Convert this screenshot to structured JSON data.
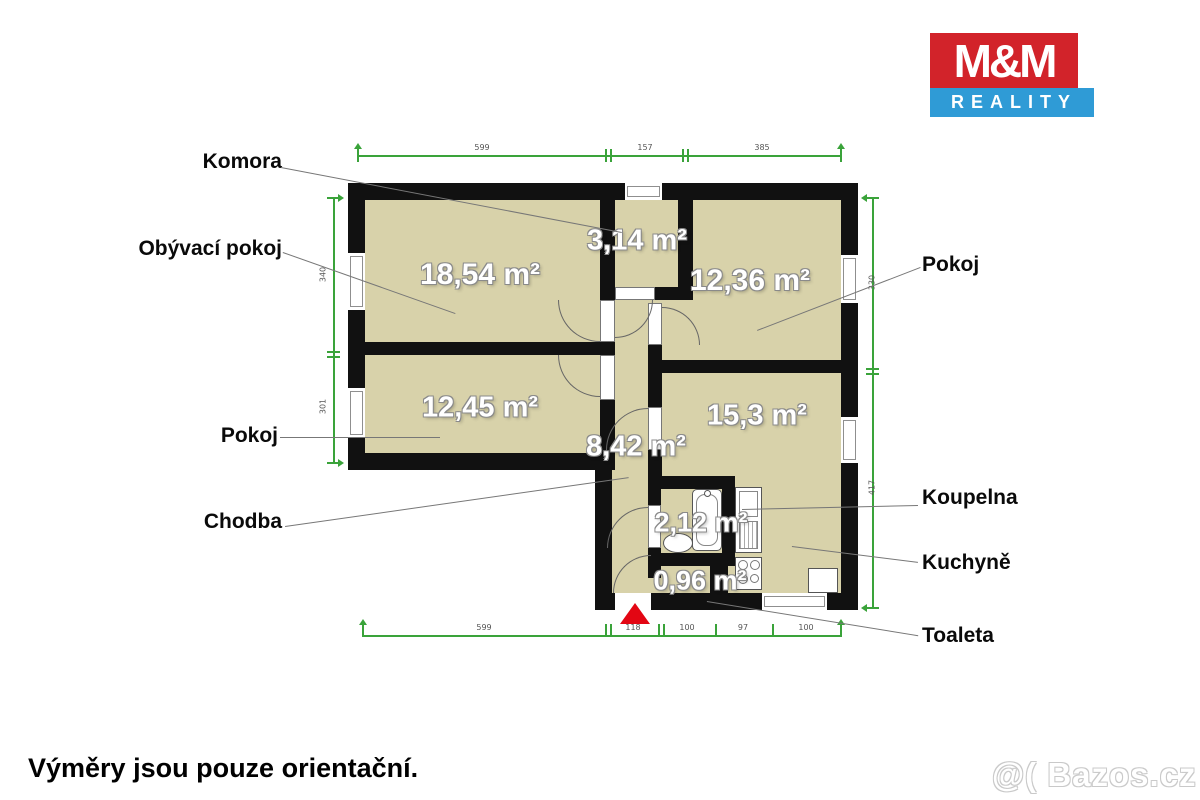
{
  "logo": {
    "top": "M&M",
    "bottom": "REALITY"
  },
  "plan": {
    "room_labels": [
      {
        "text": "Komora"
      },
      {
        "text": "Obývací pokoj"
      },
      {
        "text": "Pokoj"
      },
      {
        "text": "Chodba"
      },
      {
        "text": "Pokoj"
      },
      {
        "text": "Koupelna"
      },
      {
        "text": "Kuchyně"
      },
      {
        "text": "Toaleta"
      }
    ],
    "areas": [
      {
        "room": "Obývací pokoj",
        "text": "18,54 m²"
      },
      {
        "room": "Komora",
        "text": "3,14 m²"
      },
      {
        "room": "Pokoj pravý",
        "text": "12,36 m²"
      },
      {
        "room": "Pokoj levý",
        "text": "12,45 m²"
      },
      {
        "room": "Kuchyně",
        "text": "15,3 m²"
      },
      {
        "room": "Chodba",
        "text": "8,42 m²"
      },
      {
        "room": "Koupelna",
        "text": "2,12 m²"
      },
      {
        "room": "Toaleta",
        "text": "0,96 m²"
      }
    ],
    "dimensions": {
      "top": [
        "599",
        "157",
        "385"
      ],
      "left": [
        "340",
        "301"
      ],
      "right": [
        "330",
        "417"
      ],
      "bottom": [
        "599",
        "118",
        "100",
        "97",
        "100"
      ]
    }
  },
  "colors": {
    "floor": "#d8d2aa",
    "wall": "#111111",
    "green": "#3aa33a",
    "red": "#e30613",
    "logo_red": "#d2232a",
    "logo_blue": "#2f9bd6"
  },
  "footer": {
    "disclaimer": "Výměry jsou pouze orientační.",
    "watermark": "@( Bazos.cz"
  }
}
